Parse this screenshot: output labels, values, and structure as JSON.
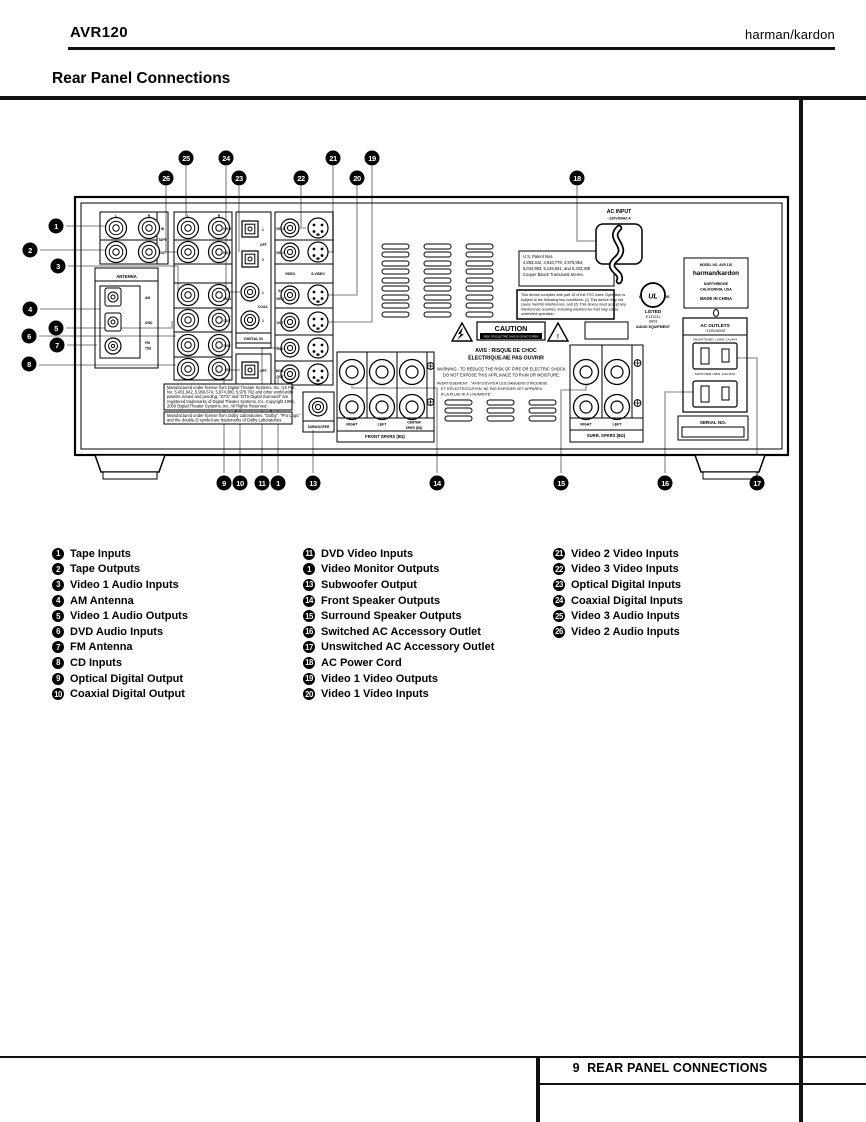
{
  "header": {
    "model": "AVR120",
    "brand": "harman/kardon"
  },
  "title": "Rear Panel Connections",
  "footer": {
    "page_number": "9",
    "title": "REAR PANEL CONNECTIONS"
  },
  "legend": {
    "columns": [
      [
        {
          "n": "1",
          "label": "Tape Inputs"
        },
        {
          "n": "2",
          "label": "Tape Outputs"
        },
        {
          "n": "3",
          "label": "Video 1 Audio Inputs"
        },
        {
          "n": "4",
          "label": "AM Antenna"
        },
        {
          "n": "5",
          "label": "Video 1 Audio Outputs"
        },
        {
          "n": "6",
          "label": "DVD Audio Inputs"
        },
        {
          "n": "7",
          "label": "FM Antenna"
        },
        {
          "n": "8",
          "label": "CD Inputs"
        },
        {
          "n": "9",
          "label": "Optical Digital Output"
        },
        {
          "n": "10",
          "label": "Coaxial Digital Output"
        }
      ],
      [
        {
          "n": "11",
          "label": "DVD Video Inputs"
        },
        {
          "n": "1",
          "label": "Video Monitor Outputs"
        },
        {
          "n": "13",
          "label": "Subwoofer Output"
        },
        {
          "n": "14",
          "label": "Front Speaker Outputs"
        },
        {
          "n": "15",
          "label": "Surround Speaker Outputs"
        },
        {
          "n": "16",
          "label": "Switched AC Accessory Outlet"
        },
        {
          "n": "17",
          "label": "Unswitched AC Accessory Outlet"
        },
        {
          "n": "18",
          "label": "AC Power Cord"
        },
        {
          "n": "19",
          "label": "Video 1 Video Outputs"
        },
        {
          "n": "20",
          "label": "Video 1 Video Inputs"
        }
      ],
      [
        {
          "n": "21",
          "label": "Video 2 Video Inputs"
        },
        {
          "n": "22",
          "label": "Video 3 Video Inputs"
        },
        {
          "n": "23",
          "label": "Optical Digital Inputs"
        },
        {
          "n": "24",
          "label": "Coaxial Digital Inputs"
        },
        {
          "n": "25",
          "label": "Video 3 Audio Inputs"
        },
        {
          "n": "26",
          "label": "Video 2 Audio Inputs"
        }
      ]
    ]
  },
  "diagram": {
    "badges": {
      "k1": "1",
      "k2": "2",
      "k3": "3",
      "k4": "4",
      "k5": "5",
      "k6": "6",
      "k7": "7",
      "k8": "8",
      "k9": "9",
      "k10": "10",
      "k11": "11",
      "k12": "1",
      "k13": "13",
      "k14": "14",
      "k15": "15",
      "k16": "16",
      "k17": "17",
      "k18": "18",
      "k19": "19",
      "k20": "20",
      "k21": "21",
      "k22": "22",
      "k23": "23",
      "k24": "24",
      "k25": "25",
      "k26": "26"
    },
    "labels": {
      "tape_l": "L",
      "tape_r": "R",
      "tape_in": "IN",
      "tape": "TAPE",
      "tape_out": "OUT",
      "a2_l": "L",
      "a2_r": "R",
      "a2_vid3": "VID 3",
      "a2_vid2": "VID 2",
      "a2_in": "IN",
      "a2_vid1": "VID 1",
      "a2_out": "OUT",
      "a2_dvd": "DVD",
      "a2_cd": "CD",
      "antenna": "ANTENNA",
      "am": "AM",
      "gnd": "GND",
      "fm": "FM",
      "ohm75": "75Ω",
      "din_1a": "1",
      "din_opt": "OPT",
      "din_2a": "2",
      "din_1b": "1",
      "din_coax": "COAX",
      "din_2b": "2",
      "din_title": "DIGITAL IN",
      "dout_opt": "OPT",
      "dout_coax": "COAX",
      "dout_title": "DIGITAL OUT",
      "v_vid3": "VID 3",
      "v_vid2": "VID 2",
      "v_video": "VIDEO",
      "v_svideo": "S-VIDEO",
      "v_in": "IN",
      "v_vid1": "VID 1",
      "v_out": "OUT",
      "v_dvd": "DVD",
      "v_mon": "MON.",
      "v_mon2": "OUT",
      "subwoofer": "SUBWOOFER",
      "fs_right": "RIGHT",
      "fs_left": "LEFT",
      "fs_center": "CENTER",
      "fs_center2": "SPKR (8Ω)",
      "fs_title": "FRONT SPKRS (8Ω)",
      "ss_right": "RIGHT",
      "ss_left": "LEFT",
      "ss_title": "SURR. SPKRS (8Ω)",
      "ac_input1": "AC INPUT",
      "ac_input2": "~120V/60HZ A",
      "ul_c": "c",
      "ul": "UL",
      "ul_us": "us",
      "ul_listed": "LISTED",
      "ul_e": "E131231",
      "ul_n": "9A03",
      "ul_ae": "AUDIO EQUIPMENT",
      "hk_model": "MODEL NO. AVR 120",
      "hk_brand": "harman/kardon",
      "hk_city": "NORTHRIDGE",
      "hk_state": "CALIFORNIA, USA",
      "hk_made": "MADE IN CHINA",
      "ao_title": "AC OUTLETS",
      "ao_v": "~120V/60HZ",
      "ao_unsw": "UNSWITCHED / 100W, 1A MAX",
      "ao_sw": "SWITCHED / 50W, 1/2A MAX",
      "serial": "SERIAL NO.",
      "caution": "CAUTION",
      "caution_sub": "RISK OF ELECTRIC SHOCK DO NOT OPEN",
      "avis1": "AVIS : RISQUE DE CHOC",
      "avis2": "ÉLECTRIQUE-NE PAS OUVRIR",
      "excl": "!"
    },
    "patent_lines": [
      "U.S. Patent Nos.",
      "4,893,342,  4,910,779,  4,975,954,",
      "5,034,983,  5,136,651,  and 5,333,308",
      "Cooper Bauck Transaural Stereo."
    ],
    "fcc_lines": [
      "This device complies with part 15 of the FCC rules. Operation is",
      "subject to the following two conditions:  (1) This device may not",
      "cause harmful interference, and  (2) This device must accept any",
      "interference received, including interference that may cause",
      "undesired operation."
    ],
    "warning_lines": [
      "WARNING :  TO REDUCE THE RISK OF FIRE OR ELECTRIC SHOCK",
      "DO NOT EXPOSE THIS APPLIANCE TO RAIN OR MOISTURE."
    ],
    "avert_lines": [
      "AVERTISSEMENT :  \"AFIN D'ÉVITER LES DANGERS D'INCENDIE",
      "ET D'ÉLECTROCUTION, NE PAS EXPOSER CET APPAREIL",
      "À LA PLUIE NI À L'HUMIDITÉ\"."
    ],
    "dts_lines": [
      "Manufactured under license from Digital Theater Systems, Inc. US Pat.",
      "No. 5,451,942, 5,956,674, 5,974,380, 5,978,762 and other world-wide",
      "patents issued and pending.  \"DTS\" and \"DTS Digital Surround\" are",
      "registered trademarks of Digital Theater Systems, Inc. Copyright 1996,",
      "2000 Digital Theater Systems, Inc. All Rights Reserved."
    ],
    "dolby_lines": [
      "Manufactured under license from Dolby Laboratories. \"Dolby\", \"Pro Logic\"",
      "and the double-D symbol are trademarks of Dolby Laboratories."
    ]
  }
}
